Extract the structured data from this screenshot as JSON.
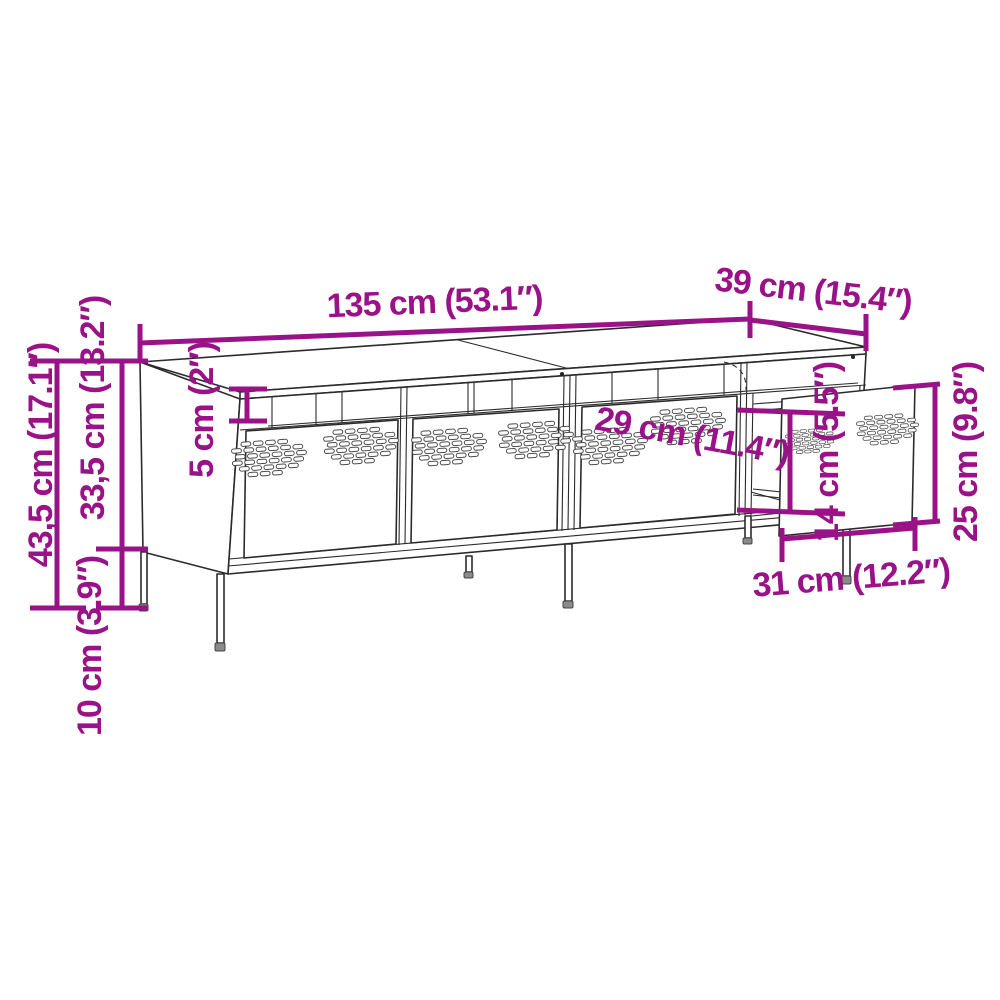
{
  "page": {
    "background_color": "#ffffff"
  },
  "diagram": {
    "type": "furniture-dimension-line-drawing",
    "subject": "TV cabinet with perforated doors and pull-out drawer",
    "accent_color": "#9a1288",
    "line_color": "#2b2b2b",
    "dims": {
      "width": "135 cm (53.1″)",
      "depth": "39 cm (15.4″)",
      "total_height": "43,5 cm (17.1″)",
      "body_height": "33,5 cm (13.2″)",
      "leg_height": "10 cm (3.9″)",
      "top_gap_height": "5 cm (2″)",
      "compartment_width": "29 cm (11.4″)",
      "drawer_inner_height": "14 cm (5.5″)",
      "drawer_front_height": "25 cm (9.8″)",
      "drawer_front_width": "31 cm (12.2″)"
    }
  }
}
